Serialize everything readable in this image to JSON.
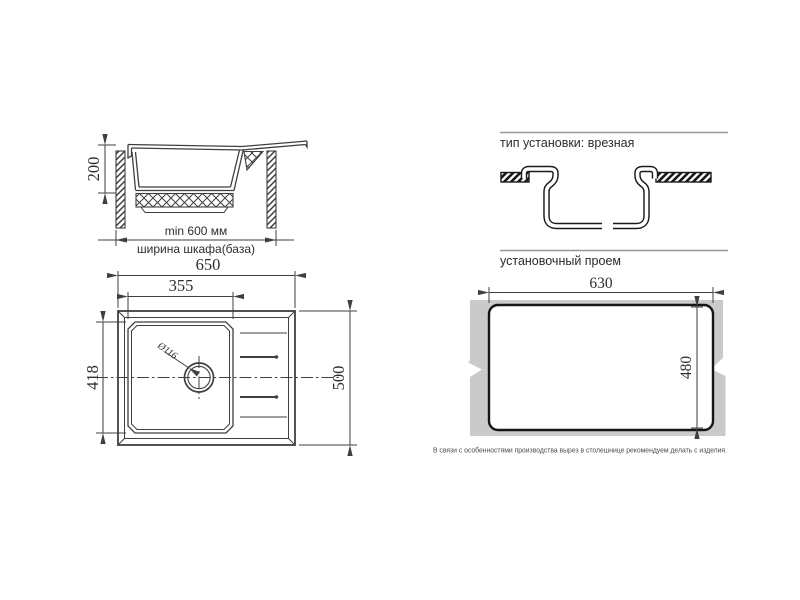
{
  "side_view": {
    "depth_mm": "200",
    "min_cabinet_width": "min 600 мм",
    "cabinet_width_label": "ширина шкафа(база)"
  },
  "top_view": {
    "overall_width_mm": "650",
    "bowl_width_mm": "355",
    "bowl_front_to_back_mm": "418",
    "overall_depth_mm": "500",
    "drain_diameter": "Ø116"
  },
  "installation": {
    "title": "тип установки: врезная"
  },
  "cutout": {
    "title": "установочный проем",
    "width_mm": "630",
    "height_mm": "480",
    "note": "В связи с особенностями производства вырез в столешнице рекомендуем делать с изделия."
  },
  "colors": {
    "line": "#3f3f3f",
    "bold_line": "#1a1a1a",
    "countertop_fill": "#cacaca",
    "rule": "#979797",
    "text": "#2e2e2e"
  }
}
